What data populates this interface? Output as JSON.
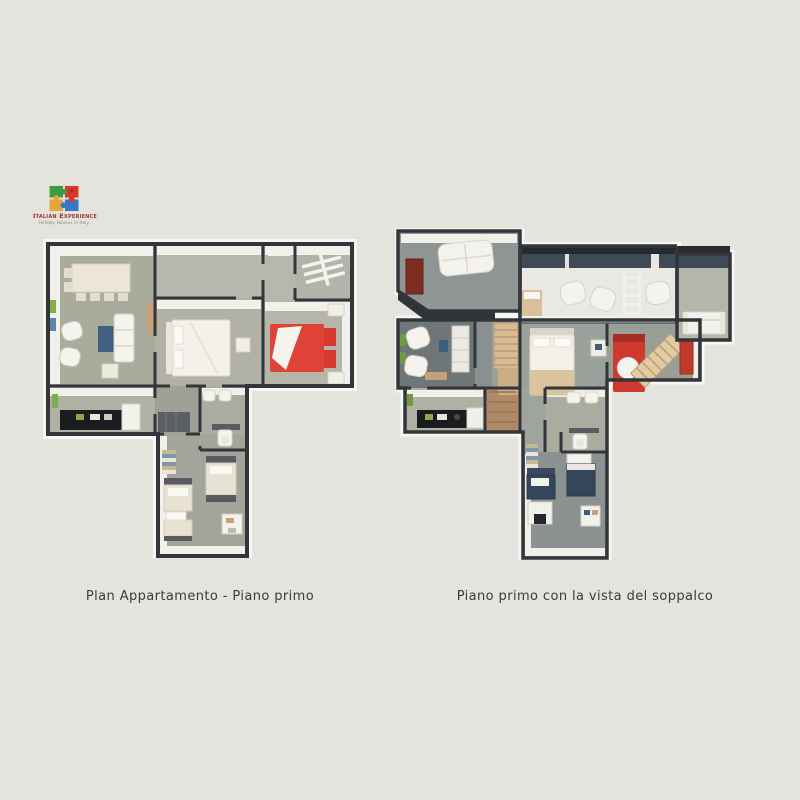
{
  "page": {
    "background_color": "#e5e3de"
  },
  "logo": {
    "brand": "Italian Experience",
    "tagline": "Holiday Houses in Italy",
    "icon": "puzzle-logo",
    "colors": {
      "green": "#3f9b3f",
      "red": "#d6362b",
      "yellow": "#e8a33d",
      "blue": "#3a77c2",
      "brand_text": "#a03535"
    }
  },
  "floorplans": {
    "left": {
      "caption": "Plan Appartamento - Piano primo"
    },
    "right": {
      "caption": "Piano primo con la vista del soppalco"
    }
  },
  "palette": {
    "wall": "#32363a",
    "floor_sage": "#adaea1",
    "floor_dark": "#70777a",
    "wall_face_white": "#f1f0ea",
    "red_bed": "#df4337",
    "navy_bed": "#35465a",
    "wood_ladder": "#d8bb92",
    "roof_slate": "#3e4a56",
    "rug_blue": "#41607f",
    "kitchen_counter": "#1b1c1f",
    "green_frame": "#7fae4e"
  }
}
